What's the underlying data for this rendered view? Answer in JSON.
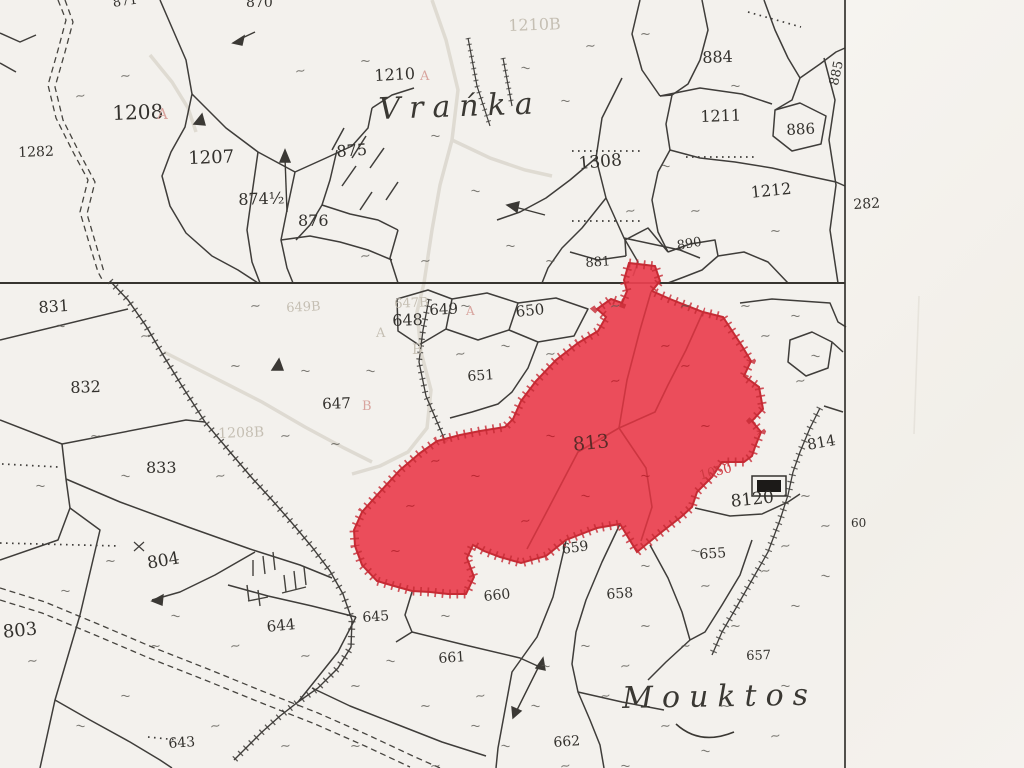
{
  "map": {
    "type": "cadastral-plan",
    "highlight": {
      "parcel_number": "813",
      "fill_color": "#ea4150",
      "edge_color": "#c62b34",
      "red_annotations": [
        "1050"
      ]
    },
    "sheet_margin_labels": [
      "282",
      "60"
    ],
    "place_names": [
      "Vrańka",
      "Mouktos"
    ],
    "symbols": {
      "grass_mark": "~",
      "building": "building-rect",
      "scarp": "hachured-line",
      "trail": "double-dashed-line"
    }
  },
  "labels": [
    {
      "text": "871",
      "x": 112,
      "y": -3,
      "size": 13,
      "rot": -8,
      "cls": "ink"
    },
    {
      "text": "870",
      "x": 246,
      "y": -4,
      "size": 14,
      "rot": 0,
      "cls": "ink"
    },
    {
      "text": "1208",
      "x": 112,
      "y": 103,
      "size": 20,
      "rot": -2,
      "cls": "ink"
    },
    {
      "text": "A",
      "x": 157,
      "y": 107,
      "size": 15,
      "rot": 0,
      "cls": "ghost-red"
    },
    {
      "text": "1282",
      "x": 18,
      "y": 146,
      "size": 14,
      "rot": -2,
      "cls": "ink"
    },
    {
      "text": "1207",
      "x": 188,
      "y": 150,
      "size": 18,
      "rot": -2,
      "cls": "ink"
    },
    {
      "text": "874½",
      "x": 238,
      "y": 192,
      "size": 16,
      "rot": -2,
      "cls": "ink"
    },
    {
      "text": "875",
      "x": 336,
      "y": 144,
      "size": 16,
      "rot": -4,
      "cls": "ink"
    },
    {
      "text": "876",
      "x": 298,
      "y": 213,
      "size": 16,
      "rot": 0,
      "cls": "ink"
    },
    {
      "text": "1210",
      "x": 374,
      "y": 68,
      "size": 16,
      "rot": -3,
      "cls": "ink"
    },
    {
      "text": "A",
      "x": 420,
      "y": 70,
      "size": 13,
      "rot": 0,
      "cls": "ghost-red"
    },
    {
      "text": "1210B",
      "x": 508,
      "y": 18,
      "size": 16,
      "rot": -2,
      "cls": "ghost"
    },
    {
      "text": "Vrańka",
      "x": 378,
      "y": 95,
      "size": 30,
      "rot": -2,
      "cls": "place"
    },
    {
      "text": "1308",
      "x": 578,
      "y": 156,
      "size": 17,
      "rot": -5,
      "cls": "ink"
    },
    {
      "text": "884",
      "x": 702,
      "y": 50,
      "size": 16,
      "rot": -2,
      "cls": "ink"
    },
    {
      "text": "1211",
      "x": 700,
      "y": 109,
      "size": 16,
      "rot": -2,
      "cls": "ink"
    },
    {
      "text": "886",
      "x": 786,
      "y": 123,
      "size": 15,
      "rot": -3,
      "cls": "ink"
    },
    {
      "text": "885",
      "x": 828,
      "y": 84,
      "size": 13,
      "rot": -78,
      "cls": "ink"
    },
    {
      "text": "1212",
      "x": 750,
      "y": 185,
      "size": 16,
      "rot": -6,
      "cls": "ink"
    },
    {
      "text": "282",
      "x": 853,
      "y": 198,
      "size": 14,
      "rot": -3,
      "cls": "ink"
    },
    {
      "text": "890",
      "x": 676,
      "y": 240,
      "size": 13,
      "rot": -10,
      "cls": "ink"
    },
    {
      "text": "881",
      "x": 585,
      "y": 257,
      "size": 13,
      "rot": -4,
      "cls": "ink"
    },
    {
      "text": "831",
      "x": 38,
      "y": 300,
      "size": 16,
      "rot": -4,
      "cls": "ink"
    },
    {
      "text": "832",
      "x": 70,
      "y": 380,
      "size": 16,
      "rot": -2,
      "cls": "ink"
    },
    {
      "text": "833",
      "x": 146,
      "y": 460,
      "size": 16,
      "rot": 0,
      "cls": "ink"
    },
    {
      "text": "649B",
      "x": 286,
      "y": 302,
      "size": 13,
      "rot": -3,
      "cls": "ghost"
    },
    {
      "text": "647B",
      "x": 394,
      "y": 298,
      "size": 13,
      "rot": -3,
      "cls": "ghost"
    },
    {
      "text": "648",
      "x": 392,
      "y": 313,
      "size": 16,
      "rot": -2,
      "cls": "ink"
    },
    {
      "text": "A",
      "x": 376,
      "y": 327,
      "size": 13,
      "rot": 0,
      "cls": "ghost"
    },
    {
      "text": "B",
      "x": 412,
      "y": 343,
      "size": 14,
      "rot": 0,
      "cls": "ghost"
    },
    {
      "text": "649",
      "x": 429,
      "y": 303,
      "size": 15,
      "rot": -3,
      "cls": "ink"
    },
    {
      "text": "A",
      "x": 466,
      "y": 305,
      "size": 12,
      "rot": 0,
      "cls": "ghost-red"
    },
    {
      "text": "650",
      "x": 515,
      "y": 305,
      "size": 15,
      "rot": -6,
      "cls": "ink"
    },
    {
      "text": "651",
      "x": 467,
      "y": 370,
      "size": 14,
      "rot": -4,
      "cls": "ink"
    },
    {
      "text": "647",
      "x": 322,
      "y": 397,
      "size": 15,
      "rot": -2,
      "cls": "ink"
    },
    {
      "text": "B",
      "x": 362,
      "y": 400,
      "size": 13,
      "rot": 0,
      "cls": "ghost-red"
    },
    {
      "text": "1208B",
      "x": 218,
      "y": 427,
      "size": 14,
      "rot": -2,
      "cls": "ghost"
    },
    {
      "text": "813",
      "x": 572,
      "y": 436,
      "size": 19,
      "rot": -6,
      "cls": "on-red"
    },
    {
      "text": "1050",
      "x": 698,
      "y": 470,
      "size": 13,
      "rot": -14,
      "cls": "red"
    },
    {
      "text": "8120",
      "x": 730,
      "y": 494,
      "size": 17,
      "rot": -6,
      "cls": "ink"
    },
    {
      "text": "814",
      "x": 806,
      "y": 438,
      "size": 15,
      "rot": -10,
      "cls": "ink"
    },
    {
      "text": "60",
      "x": 851,
      "y": 517,
      "size": 12,
      "rot": 0,
      "cls": "ink"
    },
    {
      "text": "804",
      "x": 146,
      "y": 556,
      "size": 17,
      "rot": -10,
      "cls": "ink"
    },
    {
      "text": "803",
      "x": 2,
      "y": 624,
      "size": 18,
      "rot": -6,
      "cls": "ink"
    },
    {
      "text": "644",
      "x": 266,
      "y": 620,
      "size": 15,
      "rot": -6,
      "cls": "ink"
    },
    {
      "text": "645",
      "x": 362,
      "y": 611,
      "size": 14,
      "rot": -4,
      "cls": "ink"
    },
    {
      "text": "659",
      "x": 561,
      "y": 543,
      "size": 14,
      "rot": -8,
      "cls": "ink"
    },
    {
      "text": "660",
      "x": 483,
      "y": 590,
      "size": 14,
      "rot": -6,
      "cls": "ink"
    },
    {
      "text": "658",
      "x": 606,
      "y": 588,
      "size": 14,
      "rot": -4,
      "cls": "ink"
    },
    {
      "text": "655",
      "x": 699,
      "y": 548,
      "size": 14,
      "rot": -4,
      "cls": "ink"
    },
    {
      "text": "661",
      "x": 438,
      "y": 652,
      "size": 14,
      "rot": -4,
      "cls": "ink"
    },
    {
      "text": "657",
      "x": 746,
      "y": 650,
      "size": 13,
      "rot": -2,
      "cls": "ink"
    },
    {
      "text": "662",
      "x": 553,
      "y": 736,
      "size": 14,
      "rot": -4,
      "cls": "ink"
    },
    {
      "text": "643",
      "x": 168,
      "y": 737,
      "size": 14,
      "rot": -4,
      "cls": "ink"
    },
    {
      "text": "Mouktos",
      "x": 622,
      "y": 684,
      "size": 30,
      "rot": -1,
      "cls": "place"
    }
  ]
}
